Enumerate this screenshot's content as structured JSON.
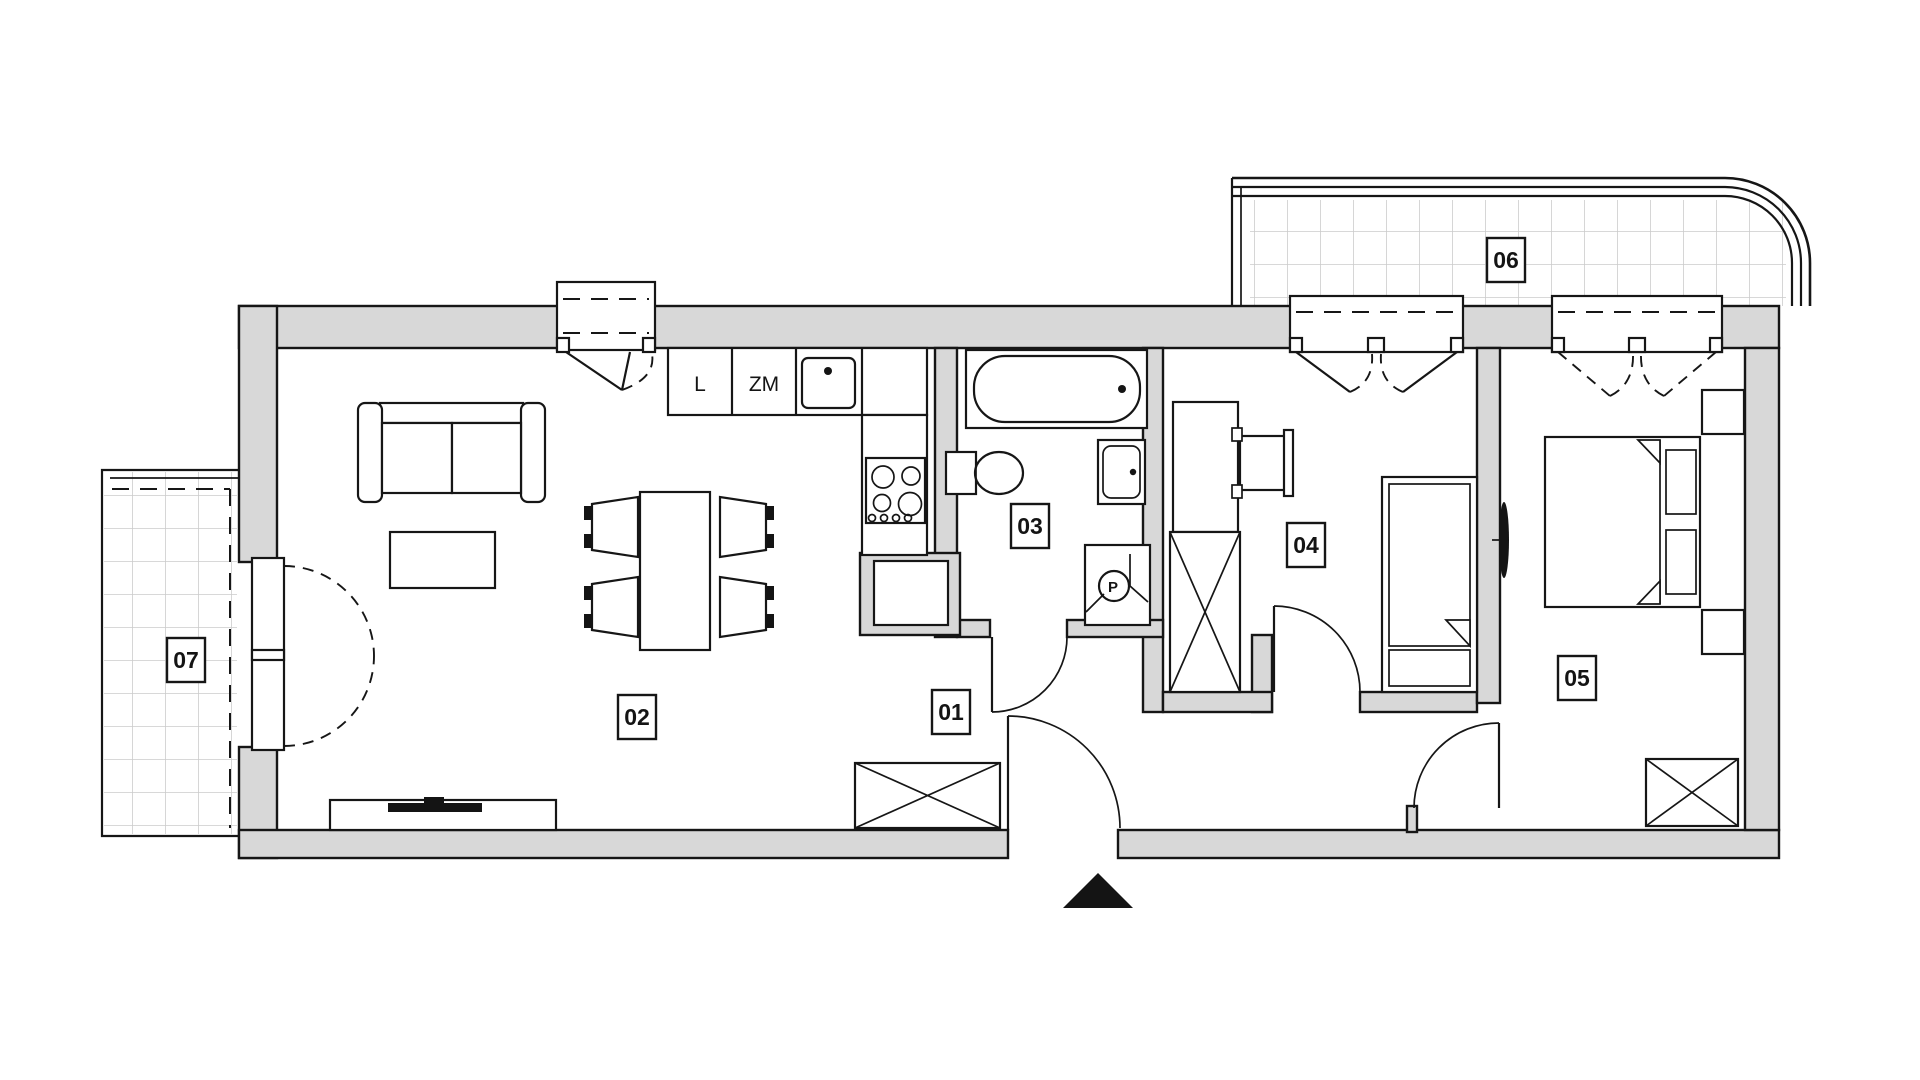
{
  "plan": {
    "room_labels": {
      "hall": "01",
      "living_room": "02",
      "bathroom": "03",
      "bedroom_small": "04",
      "bedroom_master": "05",
      "balcony": "06",
      "terrace": "07"
    },
    "kitchen": {
      "fridge": "L",
      "dishwasher": "ZM"
    },
    "symbols": {
      "washing_machine": "P"
    },
    "colors": {
      "wall_fill": "#d8d8d8",
      "line": "#161616",
      "tile_line": "#cccccc",
      "background": "#ffffff"
    }
  }
}
